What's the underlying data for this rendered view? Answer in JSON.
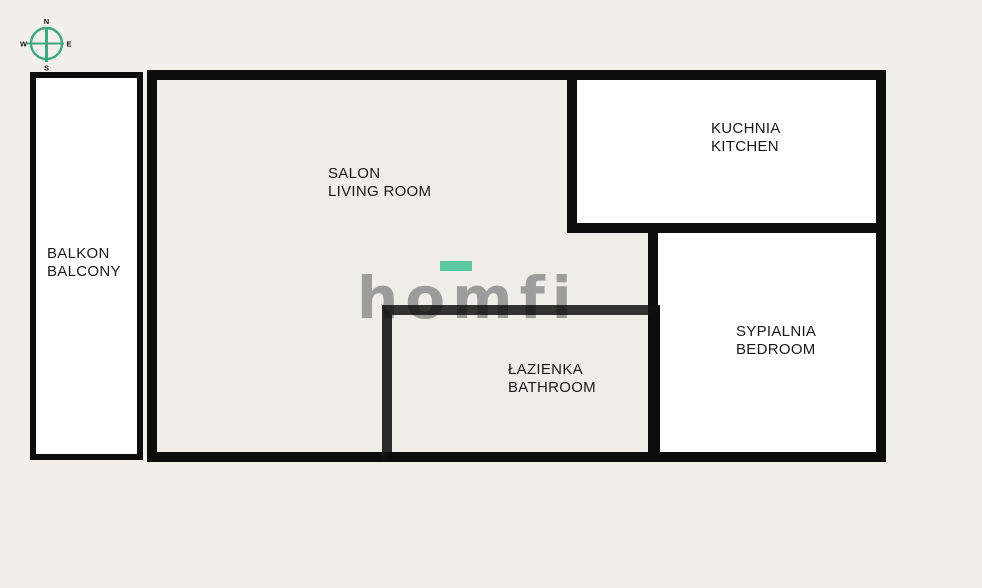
{
  "plan": {
    "type": "apartment-floor-plan",
    "palette": {
      "outer_background": "#f2f0ea",
      "apartment_fill": "#eeede7",
      "room_fill_white": "#ffffff",
      "wall_color": "#0d0d0d",
      "label_color": "#191919"
    }
  },
  "compass": {
    "north": "N",
    "east": "E",
    "south": "S",
    "west": "W",
    "color": "#3ea683"
  },
  "logo": {
    "text": "homfi",
    "letter_color": "#9c9c9c",
    "accent_color": "#5cc8a0"
  },
  "rooms": {
    "living_room": {
      "pl": "SALON",
      "en": "LIVING ROOM"
    },
    "kitchen": {
      "pl": "KUCHNIA",
      "en": "KITCHEN"
    },
    "bedroom": {
      "pl": "SYPIALNIA",
      "en": "BEDROOM"
    },
    "bathroom": {
      "pl": "ŁAZIENKA",
      "en": "BATHROOM"
    },
    "balcony": {
      "pl": "BALKON",
      "en": "BALCONY"
    }
  }
}
